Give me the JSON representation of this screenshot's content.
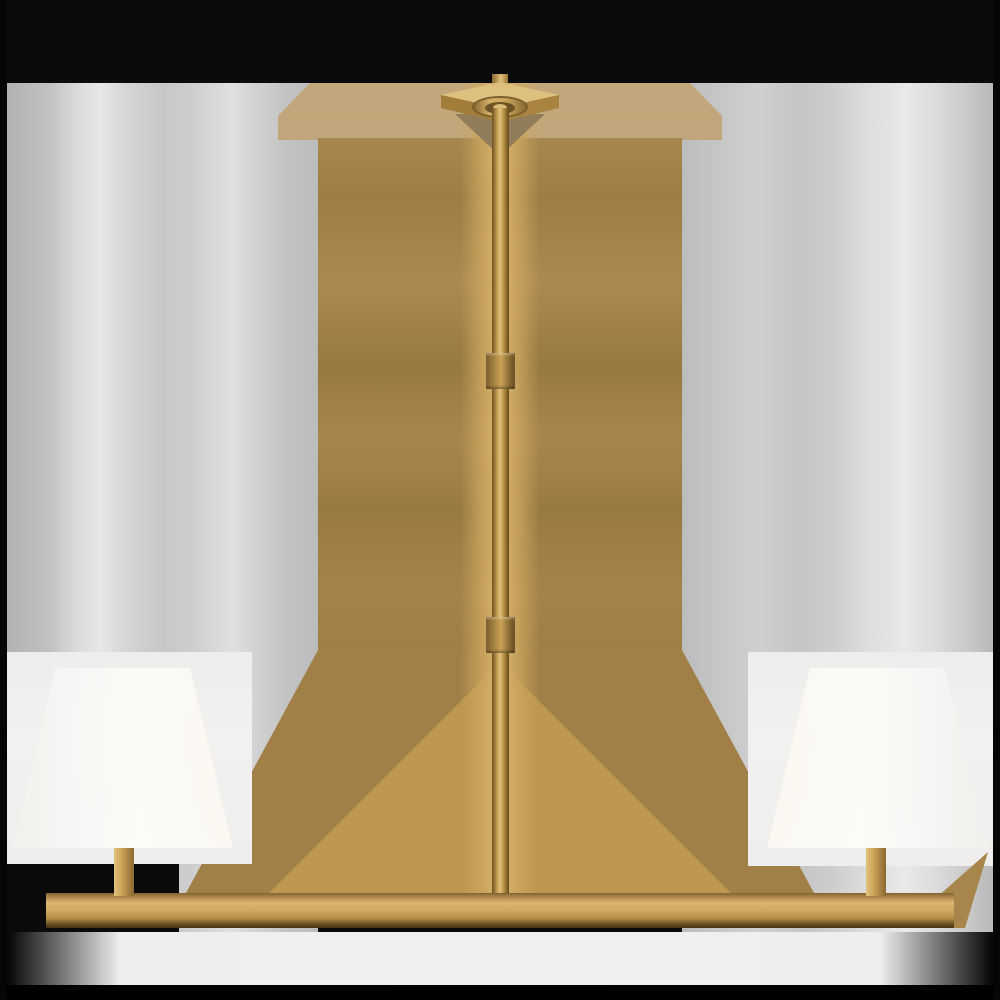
{
  "image": {
    "type": "product-photo",
    "subject": "Two-light brass linear chandelier with white linen shades",
    "lights_count": "2",
    "finish": "hand-rubbed antique brass",
    "components": {
      "canopy": "square ceiling canopy with round collar",
      "stub": "short rod above canopy",
      "downrod": "long square-profile downrod",
      "coupling_upper": "upper rod coupling",
      "coupling_lower": "lower rod coupling",
      "bar": "horizontal linear bar",
      "post_left": "left end post",
      "post_right": "right end post",
      "shade_left": "left tapered white shade",
      "shade_right": "right tapered white shade"
    },
    "palette": {
      "brass_highlight": "#e3c37f",
      "brass_mid": "#c39c52",
      "brass_dark": "#6e511f",
      "halo_tan": "#a18047",
      "halo_pale_tan": "#b79e74",
      "halo_fan_bright": "#bd964f",
      "backdrop_gray": "#c6c6c6",
      "backdrop_white": "#efeeec",
      "band_black": "#0b0b0b",
      "shade_white": "#fcfcfb"
    }
  }
}
